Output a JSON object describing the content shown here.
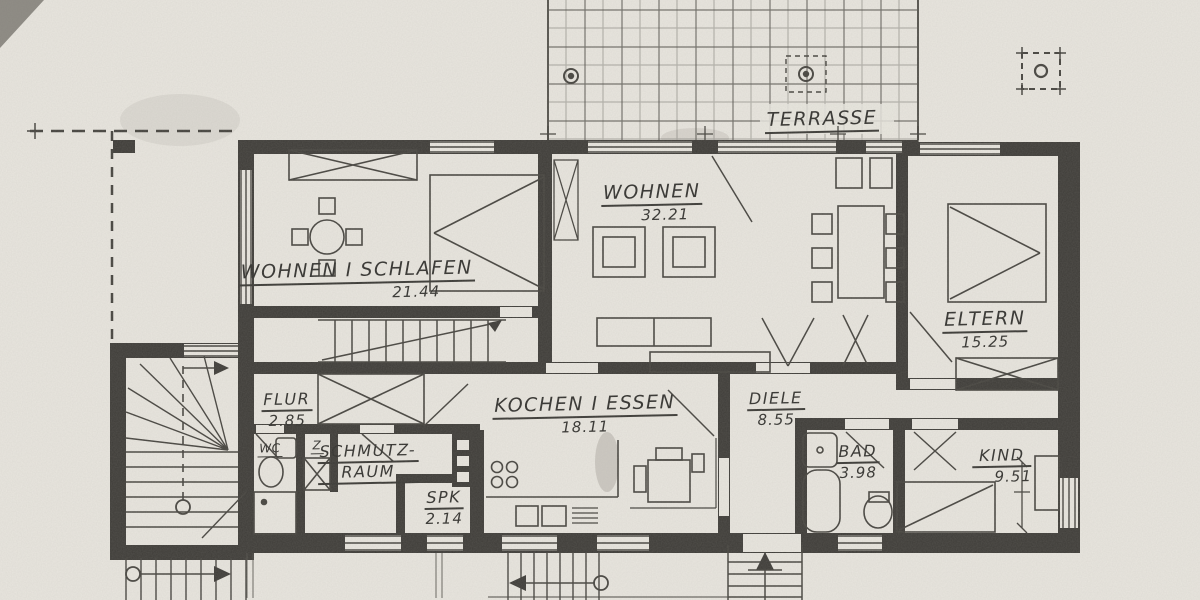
{
  "document": {
    "kind_label": "scanned floor plan",
    "paper_color": "#e9e6df",
    "ink_color": "#3e3c38"
  },
  "rooms": {
    "terrasse": {
      "label": "TERRASSE"
    },
    "wohnen": {
      "label": "WOHNEN",
      "area": "32.21"
    },
    "wohnen_schlafen": {
      "label": "WOHNEN I SCHLAFEN",
      "area": "21.44"
    },
    "eltern": {
      "label": "ELTERN",
      "area": "15.25"
    },
    "flur": {
      "label": "FLUR",
      "area": "2.85"
    },
    "kochen_essen": {
      "label": "KOCHEN I ESSEN",
      "area": "18.11"
    },
    "diele": {
      "label": "DIELE",
      "area": "8.55"
    },
    "schmutzraum": {
      "line1": "SCHMUTZ-",
      "line2": "RAUM"
    },
    "spk": {
      "label": "SPK",
      "area": "2.14"
    },
    "bad": {
      "label": "BAD",
      "area": "3.98"
    },
    "kind": {
      "label": "KIND",
      "area": "9.51"
    },
    "wc": {
      "label": "WC"
    },
    "z": {
      "label": "Z"
    }
  }
}
